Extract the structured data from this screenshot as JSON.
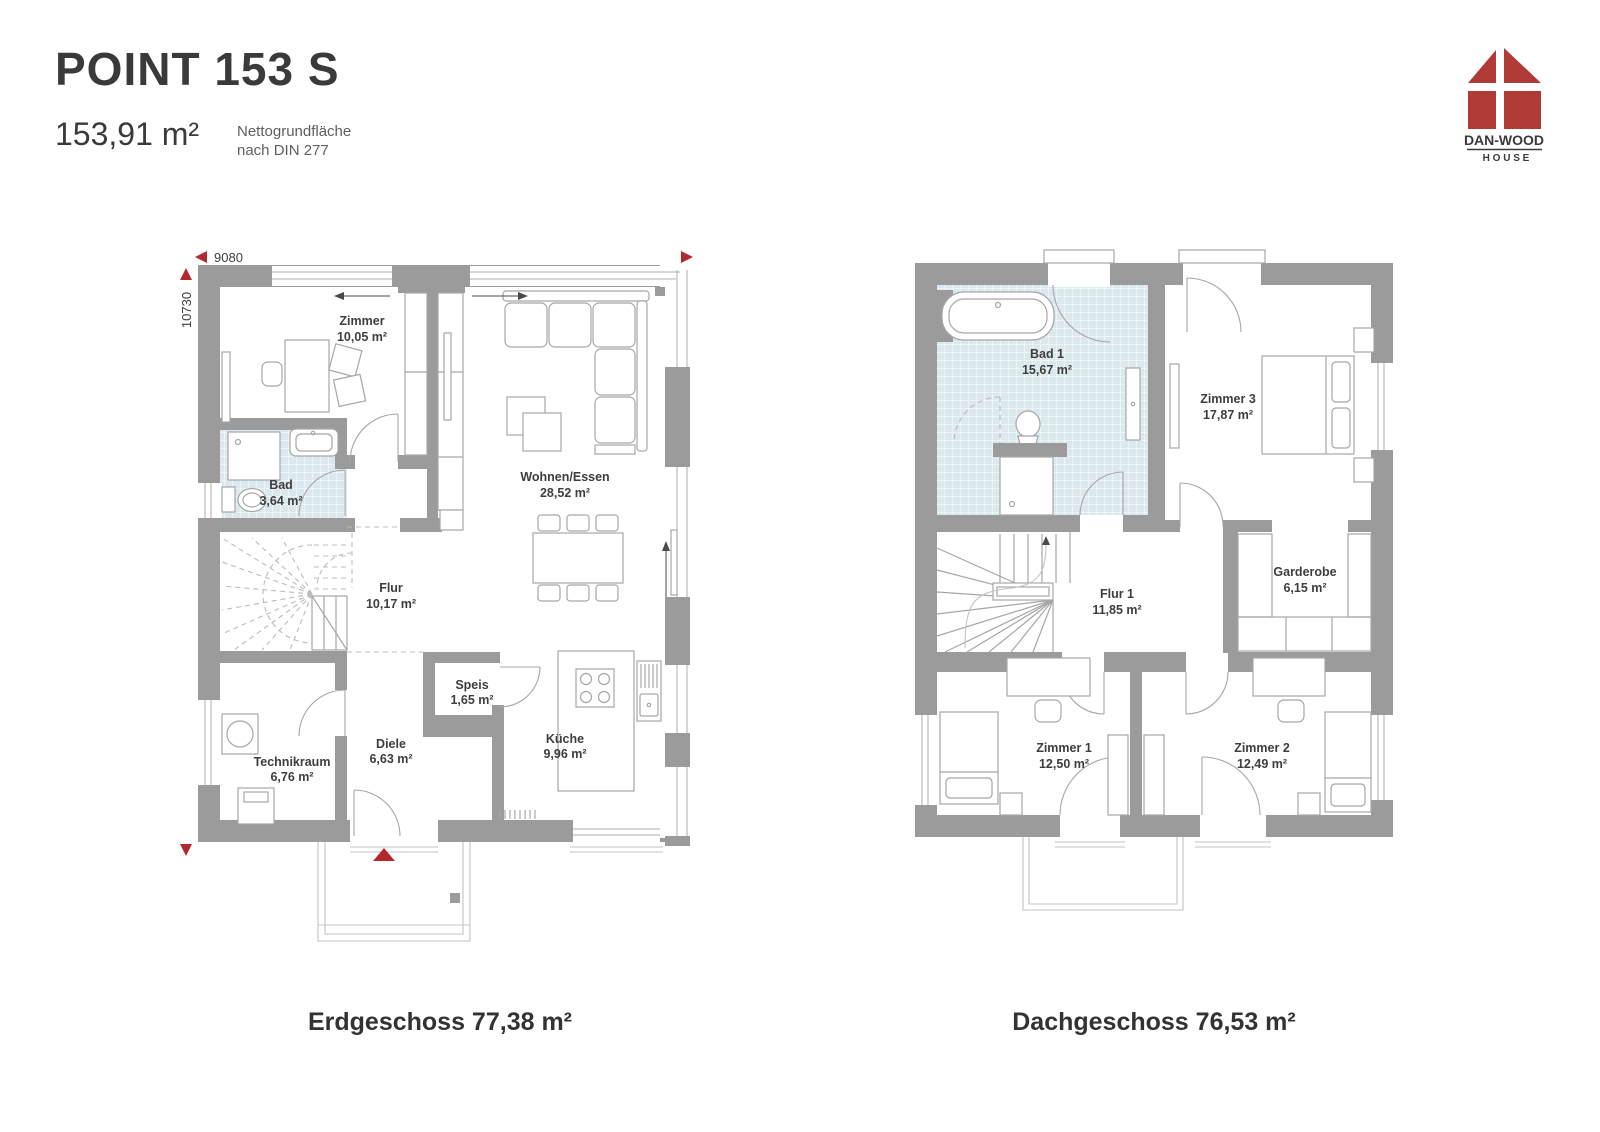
{
  "header": {
    "title": "POINT 153 S",
    "area_total": "153,91 m²",
    "area_note_1": "Nettogrundfläche",
    "area_note_2": "nach DIN 277"
  },
  "logo": {
    "brand": "DAN-WOOD",
    "sub": "H O U S E"
  },
  "dimensions": {
    "width": "9080",
    "height": "10730"
  },
  "colors": {
    "wall": "#9b9b9b",
    "tile": "#dbe8ee",
    "accent_red": "#b1292e",
    "text": "#3e3e3e"
  },
  "erdgeschoss": {
    "caption": "Erdgeschoss 77,38 m²",
    "rooms": {
      "zimmer": {
        "name": "Zimmer",
        "area": "10,05 m²"
      },
      "bad": {
        "name": "Bad",
        "area": "3,64 m²"
      },
      "flur": {
        "name": "Flur",
        "area": "10,17 m²"
      },
      "wohnen": {
        "name": "Wohnen/Essen",
        "area": "28,52 m²"
      },
      "speis": {
        "name": "Speis",
        "area": "1,65 m²"
      },
      "diele": {
        "name": "Diele",
        "area": "6,63 m²"
      },
      "technik": {
        "name": "Technikraum",
        "area": "6,76 m²"
      },
      "kueche": {
        "name": "Küche",
        "area": "9,96 m²"
      }
    }
  },
  "dachgeschoss": {
    "caption": "Dachgeschoss 76,53 m²",
    "rooms": {
      "bad1": {
        "name": "Bad 1",
        "area": "15,67 m²"
      },
      "zimmer3": {
        "name": "Zimmer 3",
        "area": "17,87 m²"
      },
      "garderobe": {
        "name": "Garderobe",
        "area": "6,15 m²"
      },
      "flur1": {
        "name": "Flur 1",
        "area": "11,85 m²"
      },
      "zimmer1": {
        "name": "Zimmer 1",
        "area": "12,50 m²"
      },
      "zimmer2": {
        "name": "Zimmer 2",
        "area": "12,49 m²"
      }
    }
  }
}
